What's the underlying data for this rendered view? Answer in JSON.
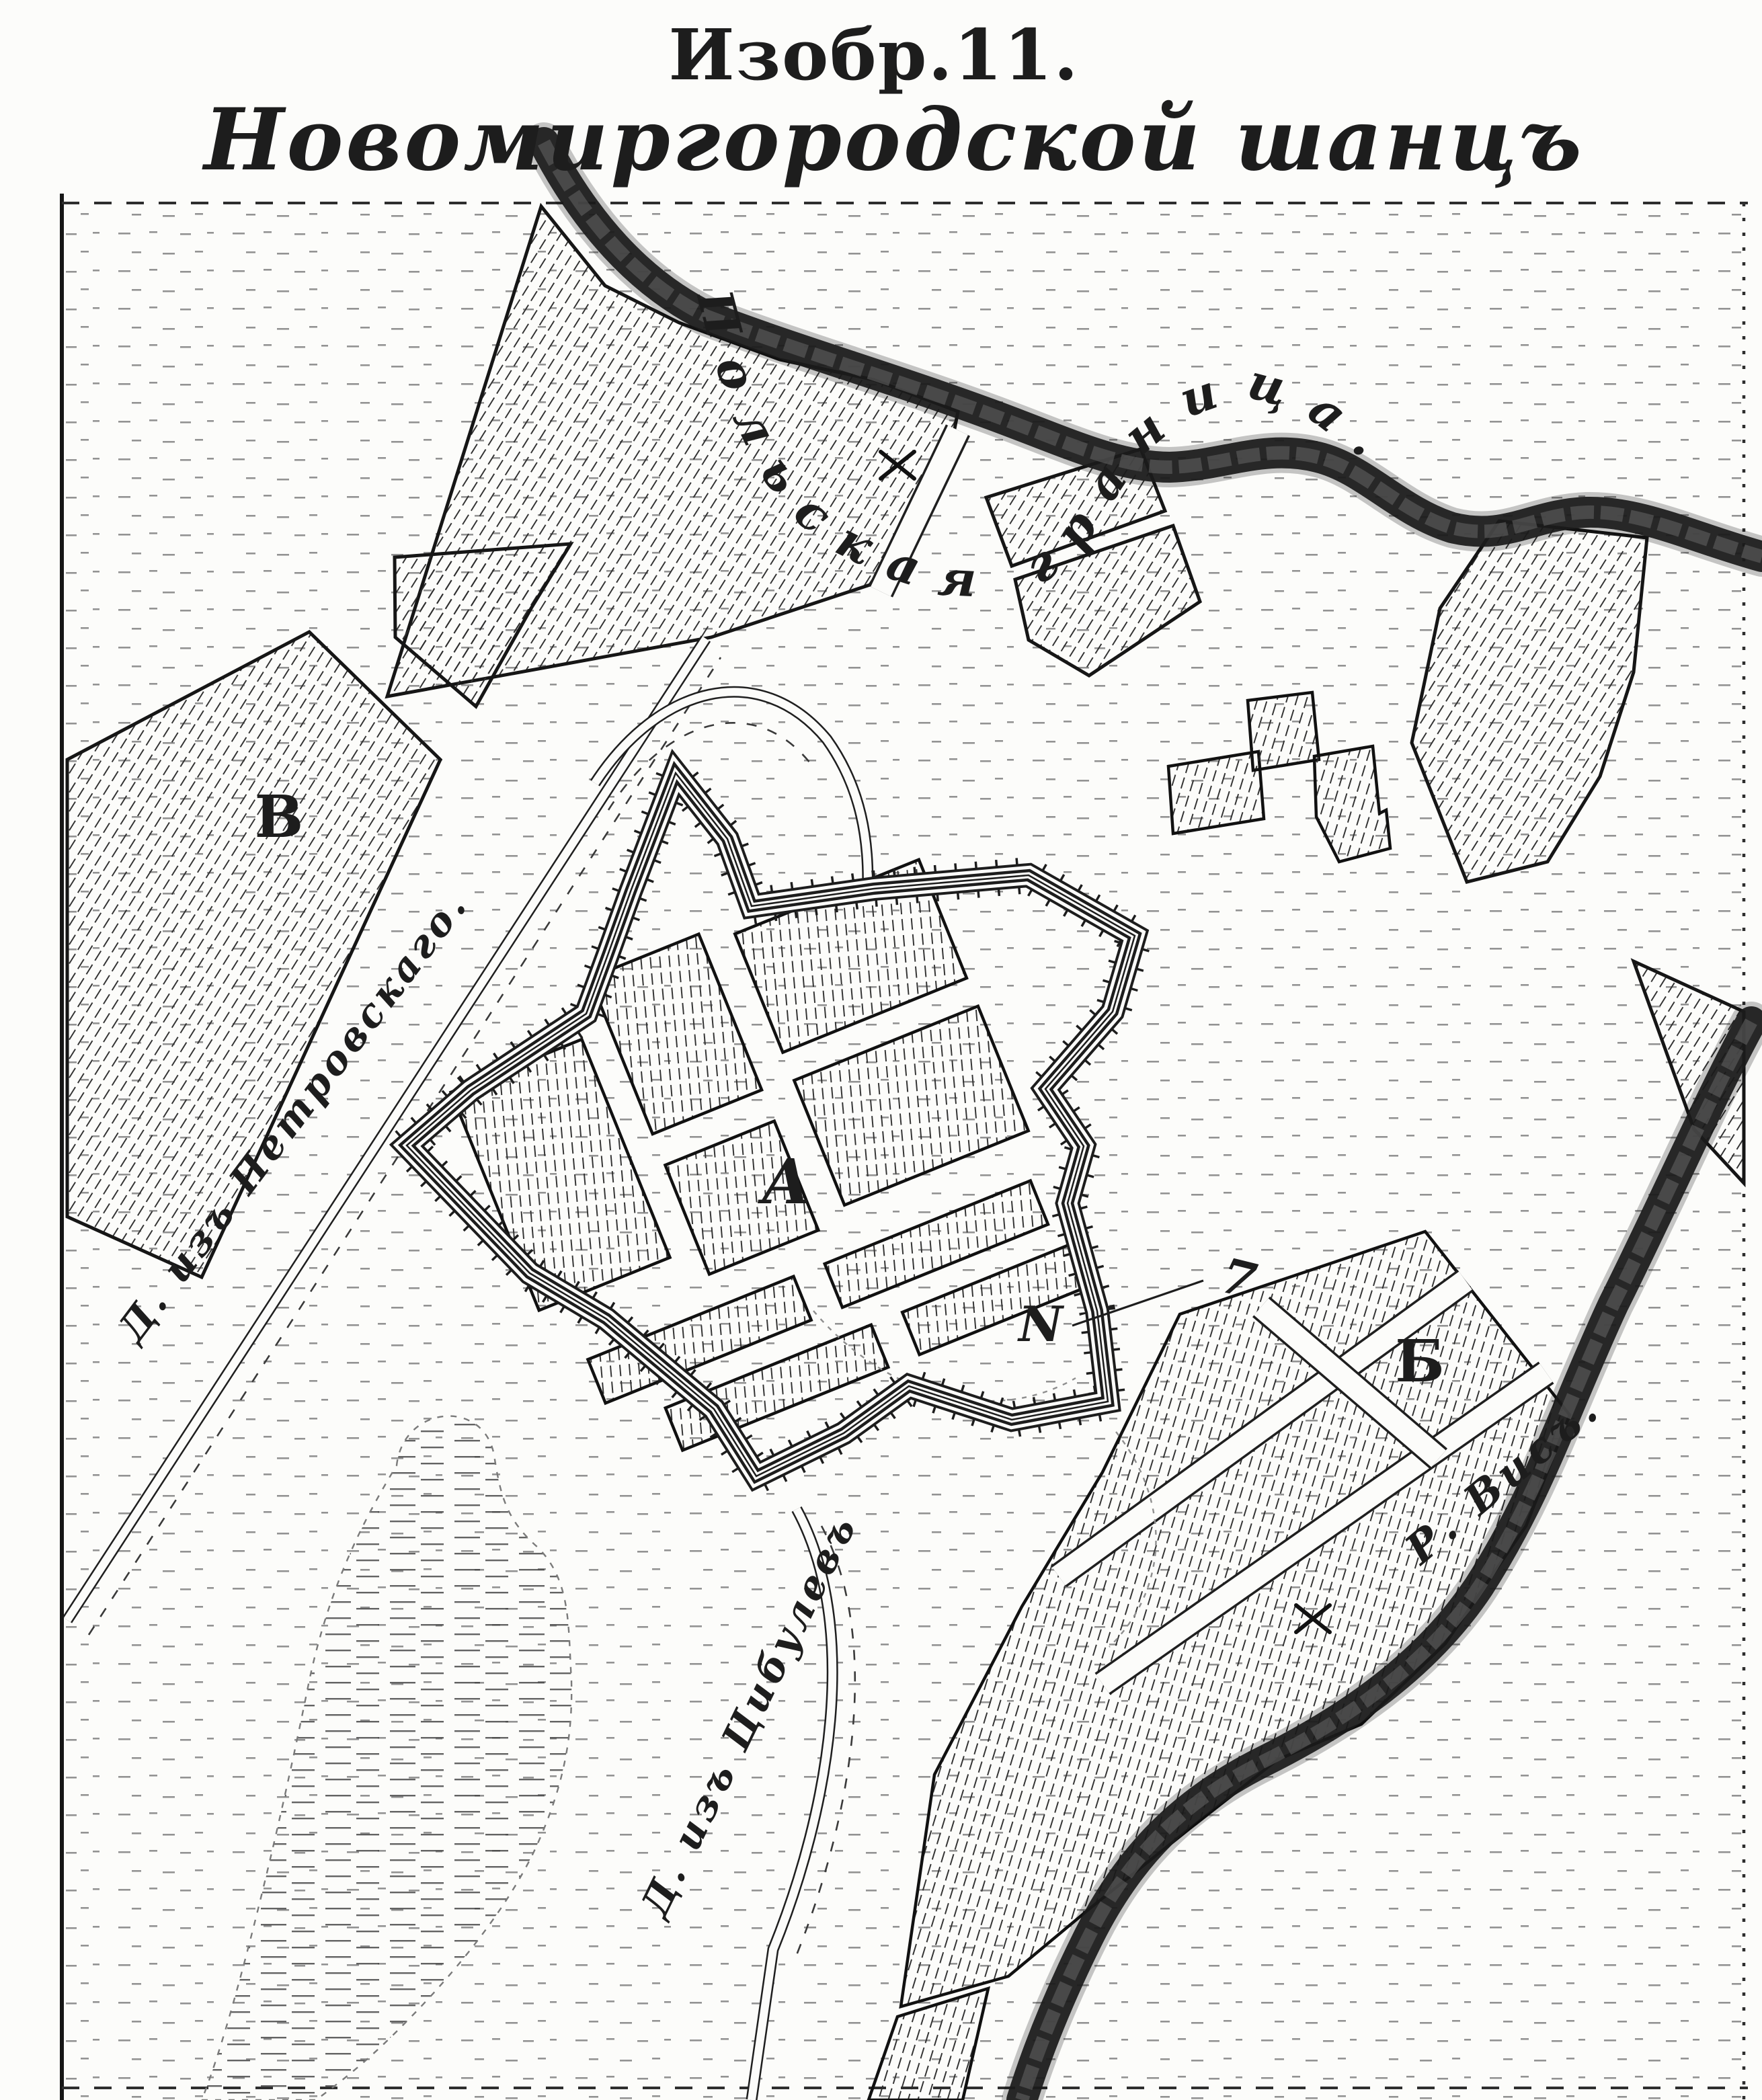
{
  "title": {
    "figure_label": "Изобр.11.",
    "map_name": "Новомиргородской шанцъ"
  },
  "labels": {
    "border_river": "Польская граница.",
    "river_vis": "Р. Висъ.",
    "road_petrovsky": "Д. изъ Петровскаго.",
    "road_tsibulev": "Д. изъ Цибулевъ",
    "area_fortress": "А",
    "area_suburb_east": "Б",
    "area_field_west": "В",
    "annotation_n": "N",
    "annotation_ref": "7"
  },
  "colors": {
    "ink": "#1d1d1d",
    "paper": "#fcfcfa"
  }
}
